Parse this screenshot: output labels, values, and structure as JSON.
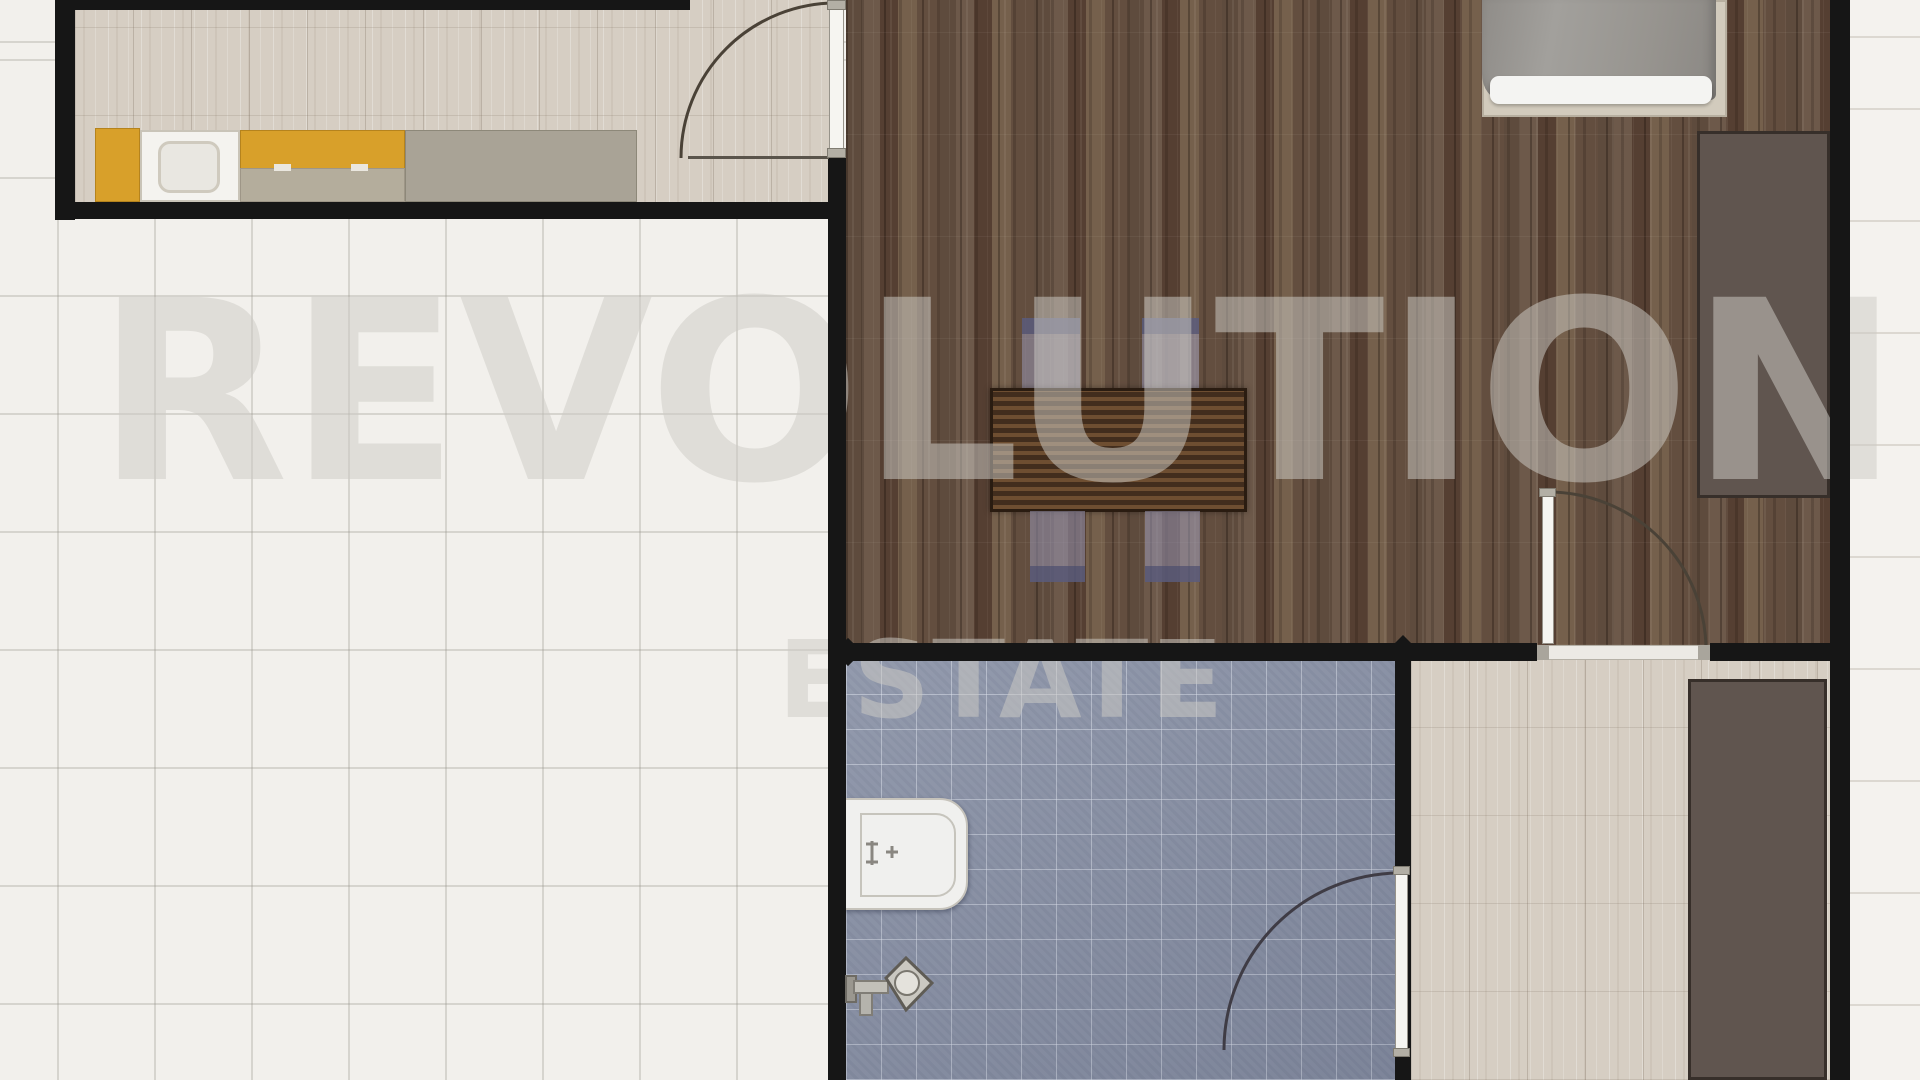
{
  "watermark": {
    "line1": "REVOLUTION",
    "line2": "ESTATE"
  },
  "palette": {
    "wall": "#161616",
    "white_tile": "#f2f0ec",
    "beige_tile": "#d6cec3",
    "wood": "#654f3e",
    "bath_tile": "#8b93a7",
    "yellow": "#d8a02a",
    "counter": "#a9a396",
    "counter_low": "#b4ad9c",
    "wardrobe": "#60554f",
    "wardrobe_border": "#372f2a",
    "chair": "rgba(152,150,178,0.55)",
    "chair_band": "rgba(70,72,108,0.62)",
    "door_leaf": "#f6f5f1",
    "door_cap": "#b3afa5",
    "bed_frame": "#d2cbbd",
    "bed_sheet": "#f4f4f2",
    "toilet": "#f0f0ee",
    "outside": "#f4f2ee",
    "outside_line": "#dcd8d1",
    "table_dark": "#422d1d",
    "table_light": "#6e4e31",
    "watermark": "rgba(206,203,197,0.52)"
  },
  "furniture_icons": [
    "bed",
    "wardrobe-bedroom",
    "wardrobe-hallway",
    "dining-table",
    "dining-chair",
    "kitchen-cabinet",
    "kitchen-sink",
    "kitchen-counter",
    "toilet",
    "shower-tap",
    "door-swing-arc"
  ]
}
